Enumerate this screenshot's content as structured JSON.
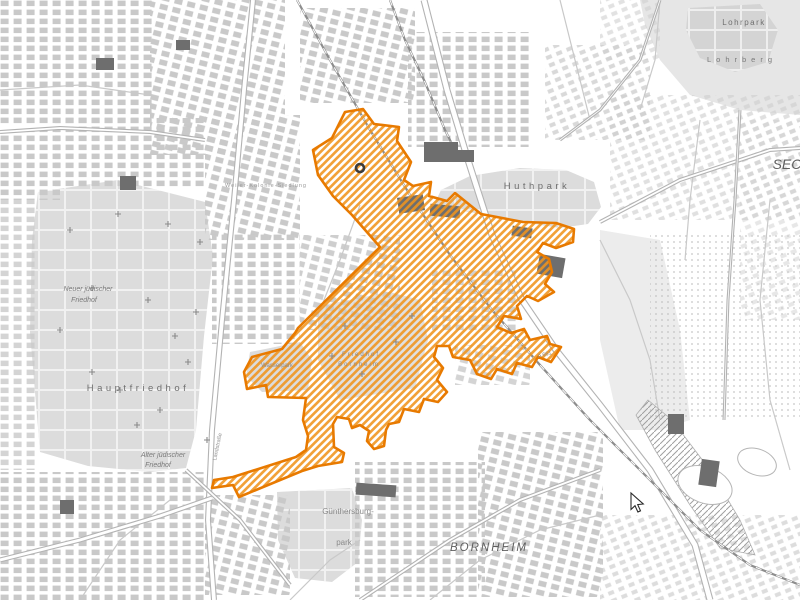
{
  "map": {
    "background": "#ffffff",
    "accent_orange_border": "#e87a00",
    "accent_orange_hatch": "#f0941d",
    "park_fill": "#dcdcdc",
    "building_fill": "#c9c9c9",
    "dark_building_fill": "#6e6e6e",
    "labels": [
      {
        "text": "Hauptfriedhof",
        "x": 138,
        "y": 391,
        "size": 9.5,
        "ls": 3.5,
        "color": "#6f6f6f"
      },
      {
        "text": "Alter jüdischer",
        "x": 163,
        "y": 457,
        "size": 7,
        "italic": true,
        "color": "#7a7a7a"
      },
      {
        "text": "Friedhof",
        "x": 158,
        "y": 467,
        "size": 7,
        "italic": true,
        "color": "#7a7a7a"
      },
      {
        "text": "Neuer jüdischer",
        "x": 88,
        "y": 291,
        "size": 7,
        "italic": true,
        "color": "#7a7a7a"
      },
      {
        "text": "Friedhof",
        "x": 84,
        "y": 302,
        "size": 7,
        "italic": true,
        "color": "#7a7a7a"
      },
      {
        "text": "Huthpark",
        "x": 537,
        "y": 189,
        "size": 9.5,
        "ls": 3.5,
        "color": "#6f6f6f"
      },
      {
        "text": "Lohrpark",
        "x": 744,
        "y": 25,
        "size": 8,
        "ls": 1.5,
        "color": "#6f6f6f"
      },
      {
        "text": "Lohrberg",
        "x": 742,
        "y": 62,
        "size": 7.5,
        "ls": 5,
        "color": "#7a7a7a"
      },
      {
        "text": "Günthersburg-",
        "x": 348,
        "y": 514,
        "size": 8,
        "color": "#8a8a8a"
      },
      {
        "text": "park",
        "x": 344,
        "y": 545,
        "size": 8,
        "color": "#8a8a8a"
      },
      {
        "text": "BORNHEIM",
        "x": 489,
        "y": 551,
        "size": 11.5,
        "italic": true,
        "ls": 2,
        "color": "#5f5f5f"
      },
      {
        "text": "SEC",
        "x": 787,
        "y": 169,
        "size": 14,
        "italic": true,
        "color": "#5f5f5f"
      },
      {
        "text": "Friedhof",
        "x": 361,
        "y": 356,
        "size": 6,
        "ls": 2,
        "color": "#8a8a8a"
      },
      {
        "text": "Bornheim",
        "x": 359,
        "y": 366,
        "size": 6,
        "ls": 2,
        "color": "#8a8a8a"
      },
      {
        "text": "Wasserpark",
        "x": 277,
        "y": 367,
        "size": 6,
        "color": "#8a8a8a"
      },
      {
        "text": "Weiler-Kolonie-Siedlung",
        "x": 266,
        "y": 187,
        "size": 5.5,
        "ls": 1,
        "color": "#9a9a9a"
      },
      {
        "text": "Landstraße",
        "x": 219,
        "y": 447,
        "size": 5.5,
        "rot": -78,
        "color": "#8f8f8f"
      },
      {
        "text": "A 661",
        "x": 545,
        "y": 356,
        "size": 5.5,
        "rot": -15,
        "color": "#8f8f8f"
      }
    ],
    "region": {
      "name": "planning-area-bornheim-seckbach",
      "path": "M345,112 L363,109 L374,124 L399,127 L397,141 L411,162 L404,180 L413,186 L431,182 L429,196 L447,201 L455,193 L481,214 L523,222 L556,223 L574,229 L573,242 L556,248 L543,243 L537,252 L549,259 L552,272 L545,284 L554,292 L538,301 L527,296 L517,306 L521,319 L504,316 L497,327 L511,333 L524,329 L530,340 L547,336 L550,344 L561,347 L551,362 L538,357 L532,367 L517,363 L512,374 L497,369 L491,379 L477,374 L470,360 L453,357 L449,346 L437,346 L434,357 L443,368 L437,380 L447,392 L438,402 L424,399 L419,412 L404,409 L399,422 L389,424 L386,430 L384,446 L374,449 L367,441 L369,431 L360,425 L352,428 L349,419 L337,417 L333,424 L334,447 L344,453 L342,462 L318,466 L302,471 L239,497 L233,485 L212,488 L214,480 L233,477 L296,457 L306,450 L308,436 L303,420 L306,398 L268,397 L266,385 L247,389 L244,372 L252,357 L282,349 L295,333 L298,328 L380,247 L352,215 L333,196 L318,175 L313,150 L332,138 Z"
    },
    "parks": [
      {
        "name": "hauptfriedhof",
        "points": "38,192 118,180 205,202 213,256 204,336 196,430 186,468 150,472 88,466 40,452 30,332 32,240",
        "grid": true
      },
      {
        "name": "huthpark",
        "points": "424,226 441,190 470,176 520,168 566,170 594,182 601,207 588,224 560,228 522,222 480,214 448,208",
        "grid": true
      },
      {
        "name": "lohrberg-slope",
        "points": "640,0 800,0 800,115 740,110 690,95 660,60 645,25",
        "fill": "#e6e6e6"
      },
      {
        "name": "lohrpark",
        "points": "688,8 760,4 778,30 768,62 735,72 700,58 686,30",
        "fill": "#d4d4d4",
        "grid": true
      },
      {
        "name": "guenthersburgpark",
        "points": "277,492 352,488 362,520 358,562 332,582 295,578 278,540",
        "grid": true
      },
      {
        "name": "wasserpark",
        "points": "250,352 300,342 312,360 308,390 262,392 246,376"
      },
      {
        "name": "friedhof-bornheim",
        "points": "318,306 390,292 420,300 428,340 415,388 340,400 318,360",
        "fill": "#e0e0e0"
      },
      {
        "name": "allotments-east",
        "points": "600,230 660,240 680,330 690,420 660,430 620,430 600,340",
        "fill": "#ececec"
      }
    ],
    "fields": [
      {
        "cx": 705,
        "cy": 485,
        "rx": 28,
        "ry": 18,
        "rot": 20
      },
      {
        "cx": 757,
        "cy": 462,
        "rx": 20,
        "ry": 13,
        "rot": 20
      }
    ],
    "clusters": [
      {
        "x": 0,
        "y": 0,
        "w": 155,
        "h": 125,
        "p": 0
      },
      {
        "x": 150,
        "y": 0,
        "w": 135,
        "h": 155,
        "p": 1
      },
      {
        "x": 55,
        "y": 118,
        "w": 150,
        "h": 70,
        "p": 0
      },
      {
        "x": 205,
        "y": 115,
        "w": 95,
        "h": 125,
        "p": 1
      },
      {
        "x": 212,
        "y": 232,
        "w": 88,
        "h": 112,
        "p": 0
      },
      {
        "x": 300,
        "y": 8,
        "w": 115,
        "h": 95,
        "p": 1
      },
      {
        "x": 408,
        "y": 32,
        "w": 125,
        "h": 115,
        "p": 0
      },
      {
        "x": 545,
        "y": 45,
        "w": 105,
        "h": 95,
        "p": 2,
        "o": 0.8
      },
      {
        "x": 610,
        "y": 95,
        "w": 190,
        "h": 125,
        "p": 2,
        "o": 0.65
      },
      {
        "x": 650,
        "y": 235,
        "w": 150,
        "h": 185,
        "p": 3,
        "o": 0.8
      },
      {
        "x": 0,
        "y": 200,
        "w": 38,
        "h": 270,
        "p": 0,
        "o": 0.8
      },
      {
        "x": 0,
        "y": 472,
        "w": 205,
        "h": 128,
        "p": 0
      },
      {
        "x": 205,
        "y": 495,
        "w": 85,
        "h": 100,
        "p": 1
      },
      {
        "x": 355,
        "y": 462,
        "w": 130,
        "h": 135,
        "p": 0
      },
      {
        "x": 478,
        "y": 432,
        "w": 125,
        "h": 165,
        "p": 1
      },
      {
        "x": 600,
        "y": 515,
        "w": 200,
        "h": 85,
        "p": 2,
        "o": 0.7
      },
      {
        "x": 300,
        "y": 235,
        "w": 100,
        "h": 95,
        "p": 1,
        "o": 0.9
      },
      {
        "x": 432,
        "y": 268,
        "w": 85,
        "h": 65,
        "p": 0,
        "o": 0.85
      },
      {
        "x": 455,
        "y": 345,
        "w": 75,
        "h": 40,
        "p": 1,
        "o": 0.8
      },
      {
        "x": 740,
        "y": 120,
        "w": 60,
        "h": 200,
        "p": 2,
        "o": 0.5
      },
      {
        "x": 600,
        "y": 0,
        "w": 60,
        "h": 60,
        "p": 2,
        "o": 0.6
      },
      {
        "x": 0,
        "y": 130,
        "w": 60,
        "h": 70,
        "p": 0
      }
    ],
    "dark_buildings": [
      [
        398,
        196,
        26,
        16,
        -8
      ],
      [
        430,
        205,
        30,
        12,
        5
      ],
      [
        538,
        256,
        26,
        20,
        10
      ],
      [
        512,
        227,
        20,
        10,
        8
      ],
      [
        424,
        142,
        34,
        20,
        0
      ],
      [
        452,
        150,
        22,
        12,
        0
      ],
      [
        120,
        176,
        16,
        14,
        0
      ],
      [
        356,
        484,
        40,
        12,
        4
      ],
      [
        60,
        500,
        14,
        14,
        0
      ],
      [
        700,
        460,
        18,
        26,
        8
      ],
      [
        668,
        414,
        16,
        20,
        0
      ],
      [
        96,
        58,
        18,
        12,
        0
      ],
      [
        176,
        40,
        14,
        10,
        0
      ]
    ],
    "roads_double": [
      {
        "pts": "253,0 244,90 234,200 222,320 212,430 208,520 214,600",
        "w": 6
      },
      {
        "pts": "424,0 447,90 468,160 492,235 522,300 556,350 600,405 650,470 695,545 710,600",
        "w": 7
      },
      {
        "pts": "0,560 80,540 160,516 212,498",
        "w": 5
      },
      {
        "pts": "0,132 60,128 150,132 205,140",
        "w": 4
      },
      {
        "pts": "600,222 680,180 770,150 800,148",
        "w": 4
      },
      {
        "pts": "186,470 240,520 290,585",
        "w": 4
      },
      {
        "pts": "360,600 450,540 520,500 600,470",
        "w": 4
      },
      {
        "pts": "660,0 640,60 600,110 560,140",
        "w": 3
      },
      {
        "pts": "740,110 735,200 728,300 724,420",
        "w": 3
      }
    ],
    "roads_single": [
      {
        "pts": "600,240 630,300 650,360 660,420"
      },
      {
        "pts": "700,120 690,200 685,260"
      },
      {
        "pts": "0,90 80,85 150,95"
      },
      {
        "pts": "80,600 120,540 170,500"
      },
      {
        "pts": "290,600 330,560 360,540"
      },
      {
        "pts": "430,600 480,560 540,530 600,515"
      },
      {
        "pts": "560,0 575,60 590,120"
      },
      {
        "pts": "660,0 655,60 640,110"
      },
      {
        "pts": "770,200 760,300 770,400 790,470"
      },
      {
        "pts": "360,205 340,260 320,310"
      }
    ],
    "railways": [
      {
        "pts": "297,0 330,60 370,130 410,195 450,255 492,310 540,365 590,420 650,480 700,530 750,565 800,585"
      },
      {
        "pts": "390,0 405,40 424,80 445,130 460,160"
      }
    ],
    "rail_yard": "648,400 672,420 710,470 740,520 755,555 720,548 690,505 655,450 636,415",
    "crosses": [
      [
        70,
        230
      ],
      [
        118,
        214
      ],
      [
        168,
        224
      ],
      [
        200,
        242
      ],
      [
        92,
        288
      ],
      [
        148,
        300
      ],
      [
        196,
        312
      ],
      [
        175,
        336
      ],
      [
        92,
        372
      ],
      [
        137,
        425
      ],
      [
        188,
        362
      ],
      [
        207,
        440
      ],
      [
        60,
        330
      ],
      [
        120,
        390
      ],
      [
        160,
        410
      ],
      [
        332,
        356
      ],
      [
        362,
        374
      ],
      [
        396,
        342
      ],
      [
        412,
        316
      ],
      [
        345,
        326
      ]
    ],
    "station_marker": {
      "x": 360,
      "y": 168
    },
    "cursor": {
      "x": 631,
      "y": 493
    }
  }
}
